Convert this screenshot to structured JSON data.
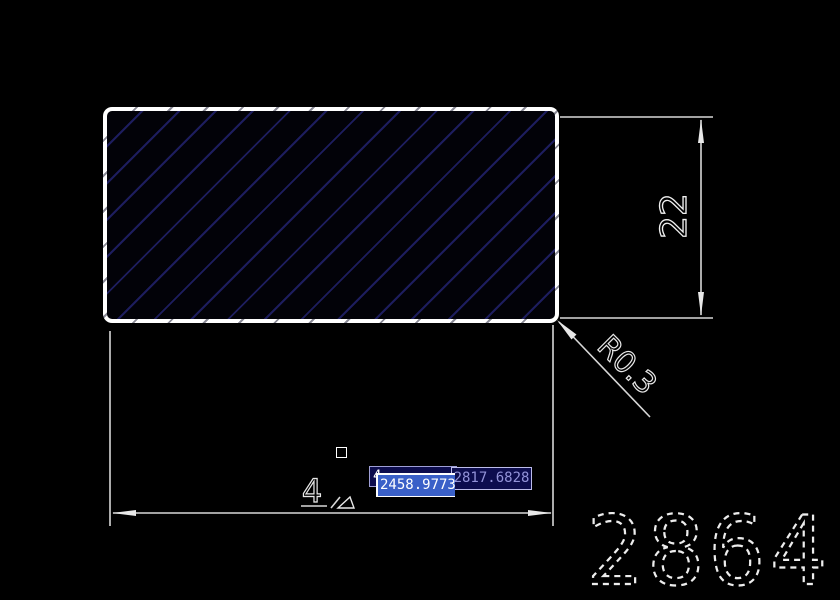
{
  "app": {
    "type": "cad-drawing-view",
    "background": "#000000"
  },
  "drawing": {
    "rectangle": {
      "border_color": "#ffffff",
      "fill_color": "#020208",
      "hatch_color": "#1d1d5e",
      "hatch_pattern": "diagonal-45"
    },
    "vertical_dimension": {
      "value": "22"
    },
    "radius_dimension": {
      "value": "R0.3"
    },
    "horizontal_dimension": {
      "visible_text": "4"
    },
    "watermark": {
      "value": "2864"
    }
  },
  "dynamic_input": {
    "field_behind": {
      "visible_text": "4"
    },
    "field_x": {
      "value": "2458.9773",
      "selected": true
    },
    "field_y": {
      "value": "2817.6828"
    }
  },
  "cursor": {
    "type": "pickbox"
  },
  "colors": {
    "dim_line": "#d8d8d8",
    "arrow_fill": "#e8e8e8",
    "input_bg": "#0d0d4e",
    "input_border": "#9f9fd6",
    "input_text": "#9292d8",
    "selection_highlight": "#3a60c8"
  }
}
